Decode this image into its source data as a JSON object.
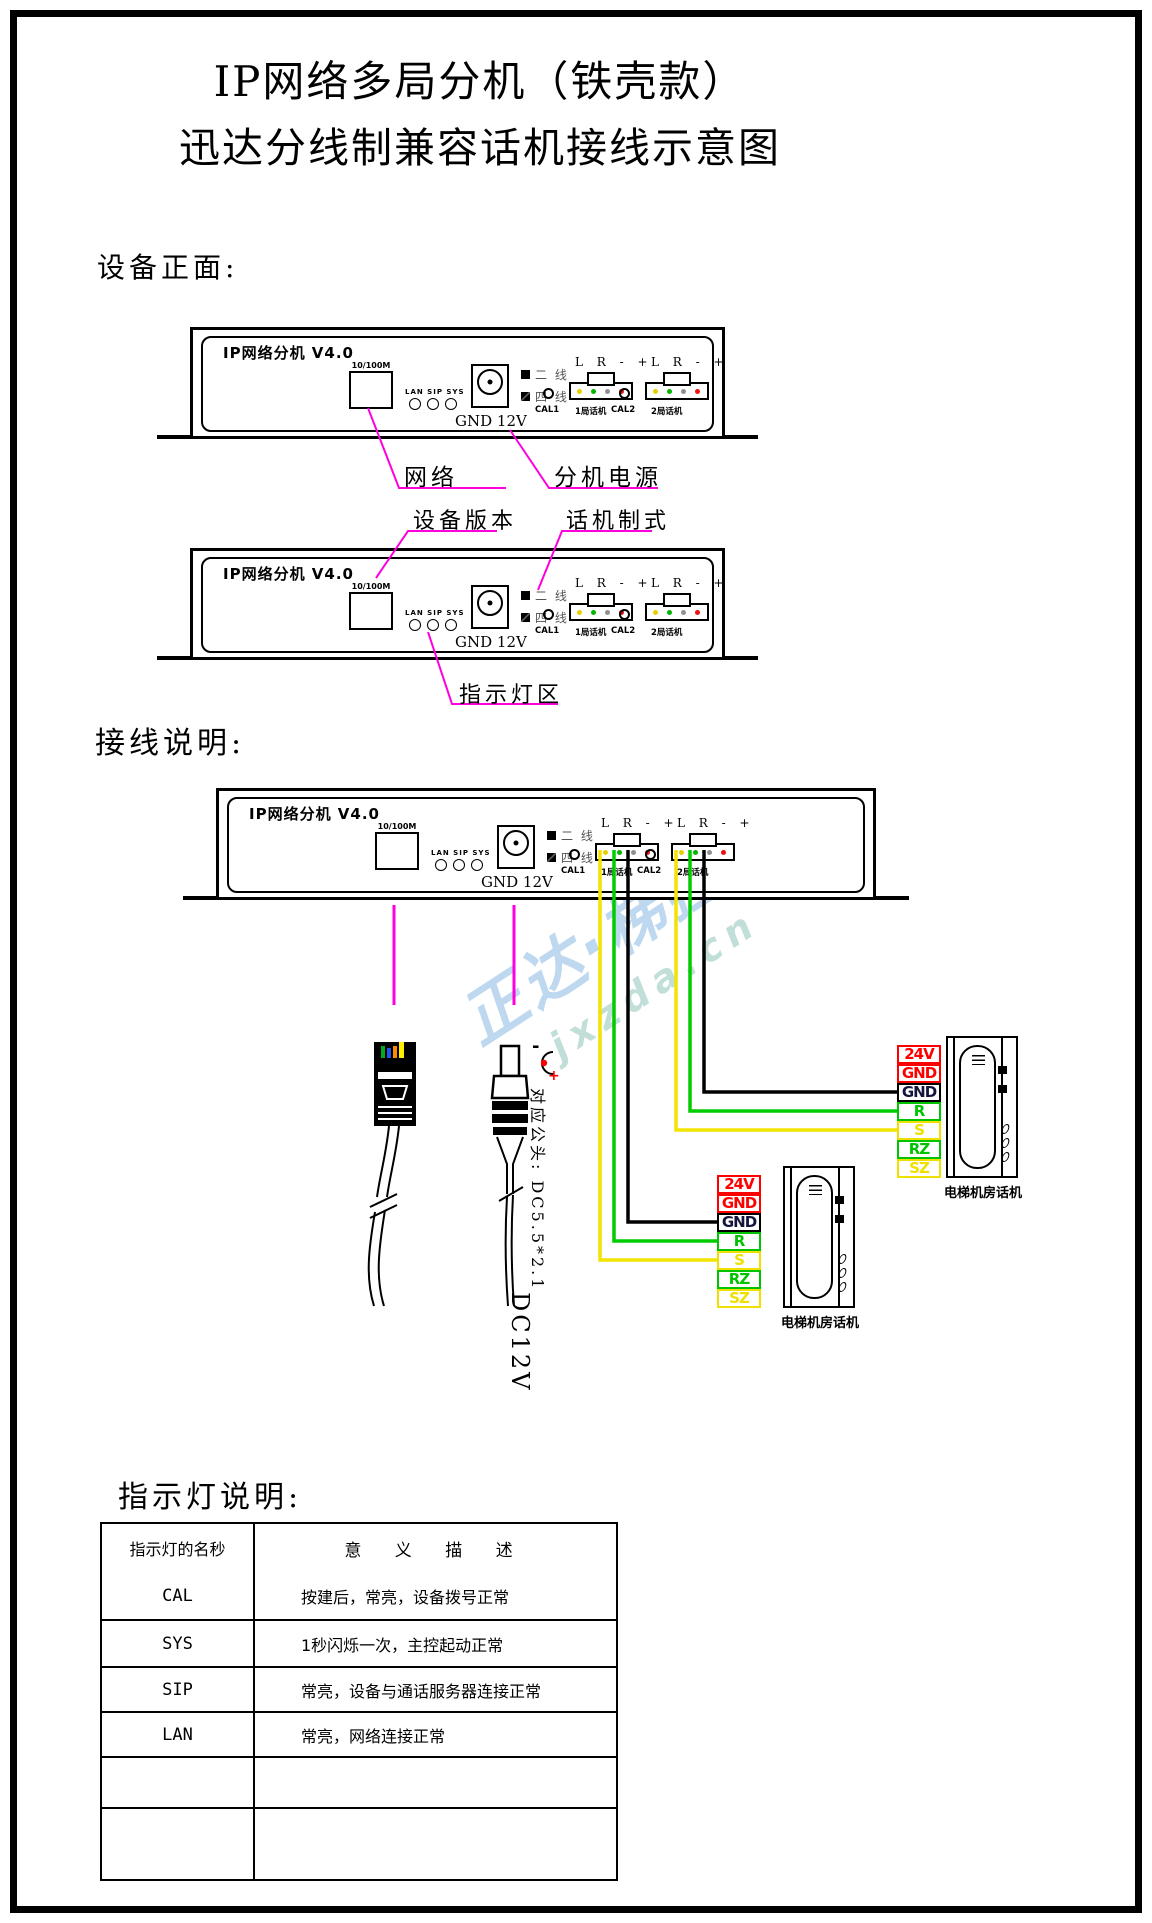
{
  "title": {
    "line1": "IP网络多局分机（铁壳款）",
    "line2": "迅达分线制兼容话机接线示意图"
  },
  "sections": {
    "front": "设备正面:",
    "wiring": "接线说明:",
    "leds": "指示灯说明:"
  },
  "device": {
    "name": "IP网络分机 V4.0",
    "network_port": "10/100M",
    "led_group": "LAN SIP SYS",
    "power": "GND 12V",
    "mode_2wire": "二 线",
    "mode_4wire": "四 线",
    "line_header": "L R - +",
    "cal1": "CAL1",
    "phone1": "1局话机",
    "cal2": "CAL2",
    "phone2": "2局话机"
  },
  "callouts": {
    "color": "#ff00dd",
    "network": "网络",
    "ext_power": "分机电源",
    "device_version": "设备版本",
    "phone_standard": "话机制式",
    "indicator_area": "指示灯区"
  },
  "wiring": {
    "plug_note": "对应公头: DC5.5*2.1",
    "dc_label": "DC12V",
    "polarity_minus": "-",
    "polarity_plus": "+",
    "wire_colors": {
      "L": "#f2e300",
      "R": "#00cc00",
      "GND": "#000000"
    },
    "terminal_rows": [
      {
        "label": "24V",
        "color": "red"
      },
      {
        "label": "GND",
        "color": "red"
      },
      {
        "label": "GND",
        "color": "black"
      },
      {
        "label": "R",
        "color": "green"
      },
      {
        "label": "S",
        "color": "yellow"
      },
      {
        "label": "RZ",
        "color": "green"
      },
      {
        "label": "SZ",
        "color": "yellow"
      }
    ],
    "phone_label": "电梯机房话机"
  },
  "watermark": {
    "text": "正达·梯控",
    "domain": "jxzda.cn"
  },
  "led_table": {
    "col1_header": "指示灯的名秒",
    "col2_header": "意 义 描 述",
    "rows": [
      {
        "name": "CAL",
        "desc": "按建后，常亮，设备拨号正常"
      },
      {
        "name": "SYS",
        "desc": "1秒闪烁一次，主控起动正常"
      },
      {
        "name": "SIP",
        "desc": "常亮，设备与通话服务器连接正常"
      },
      {
        "name": "LAN",
        "desc": "常亮，网络连接正常"
      },
      {
        "name": "",
        "desc": ""
      },
      {
        "name": "",
        "desc": ""
      }
    ]
  }
}
